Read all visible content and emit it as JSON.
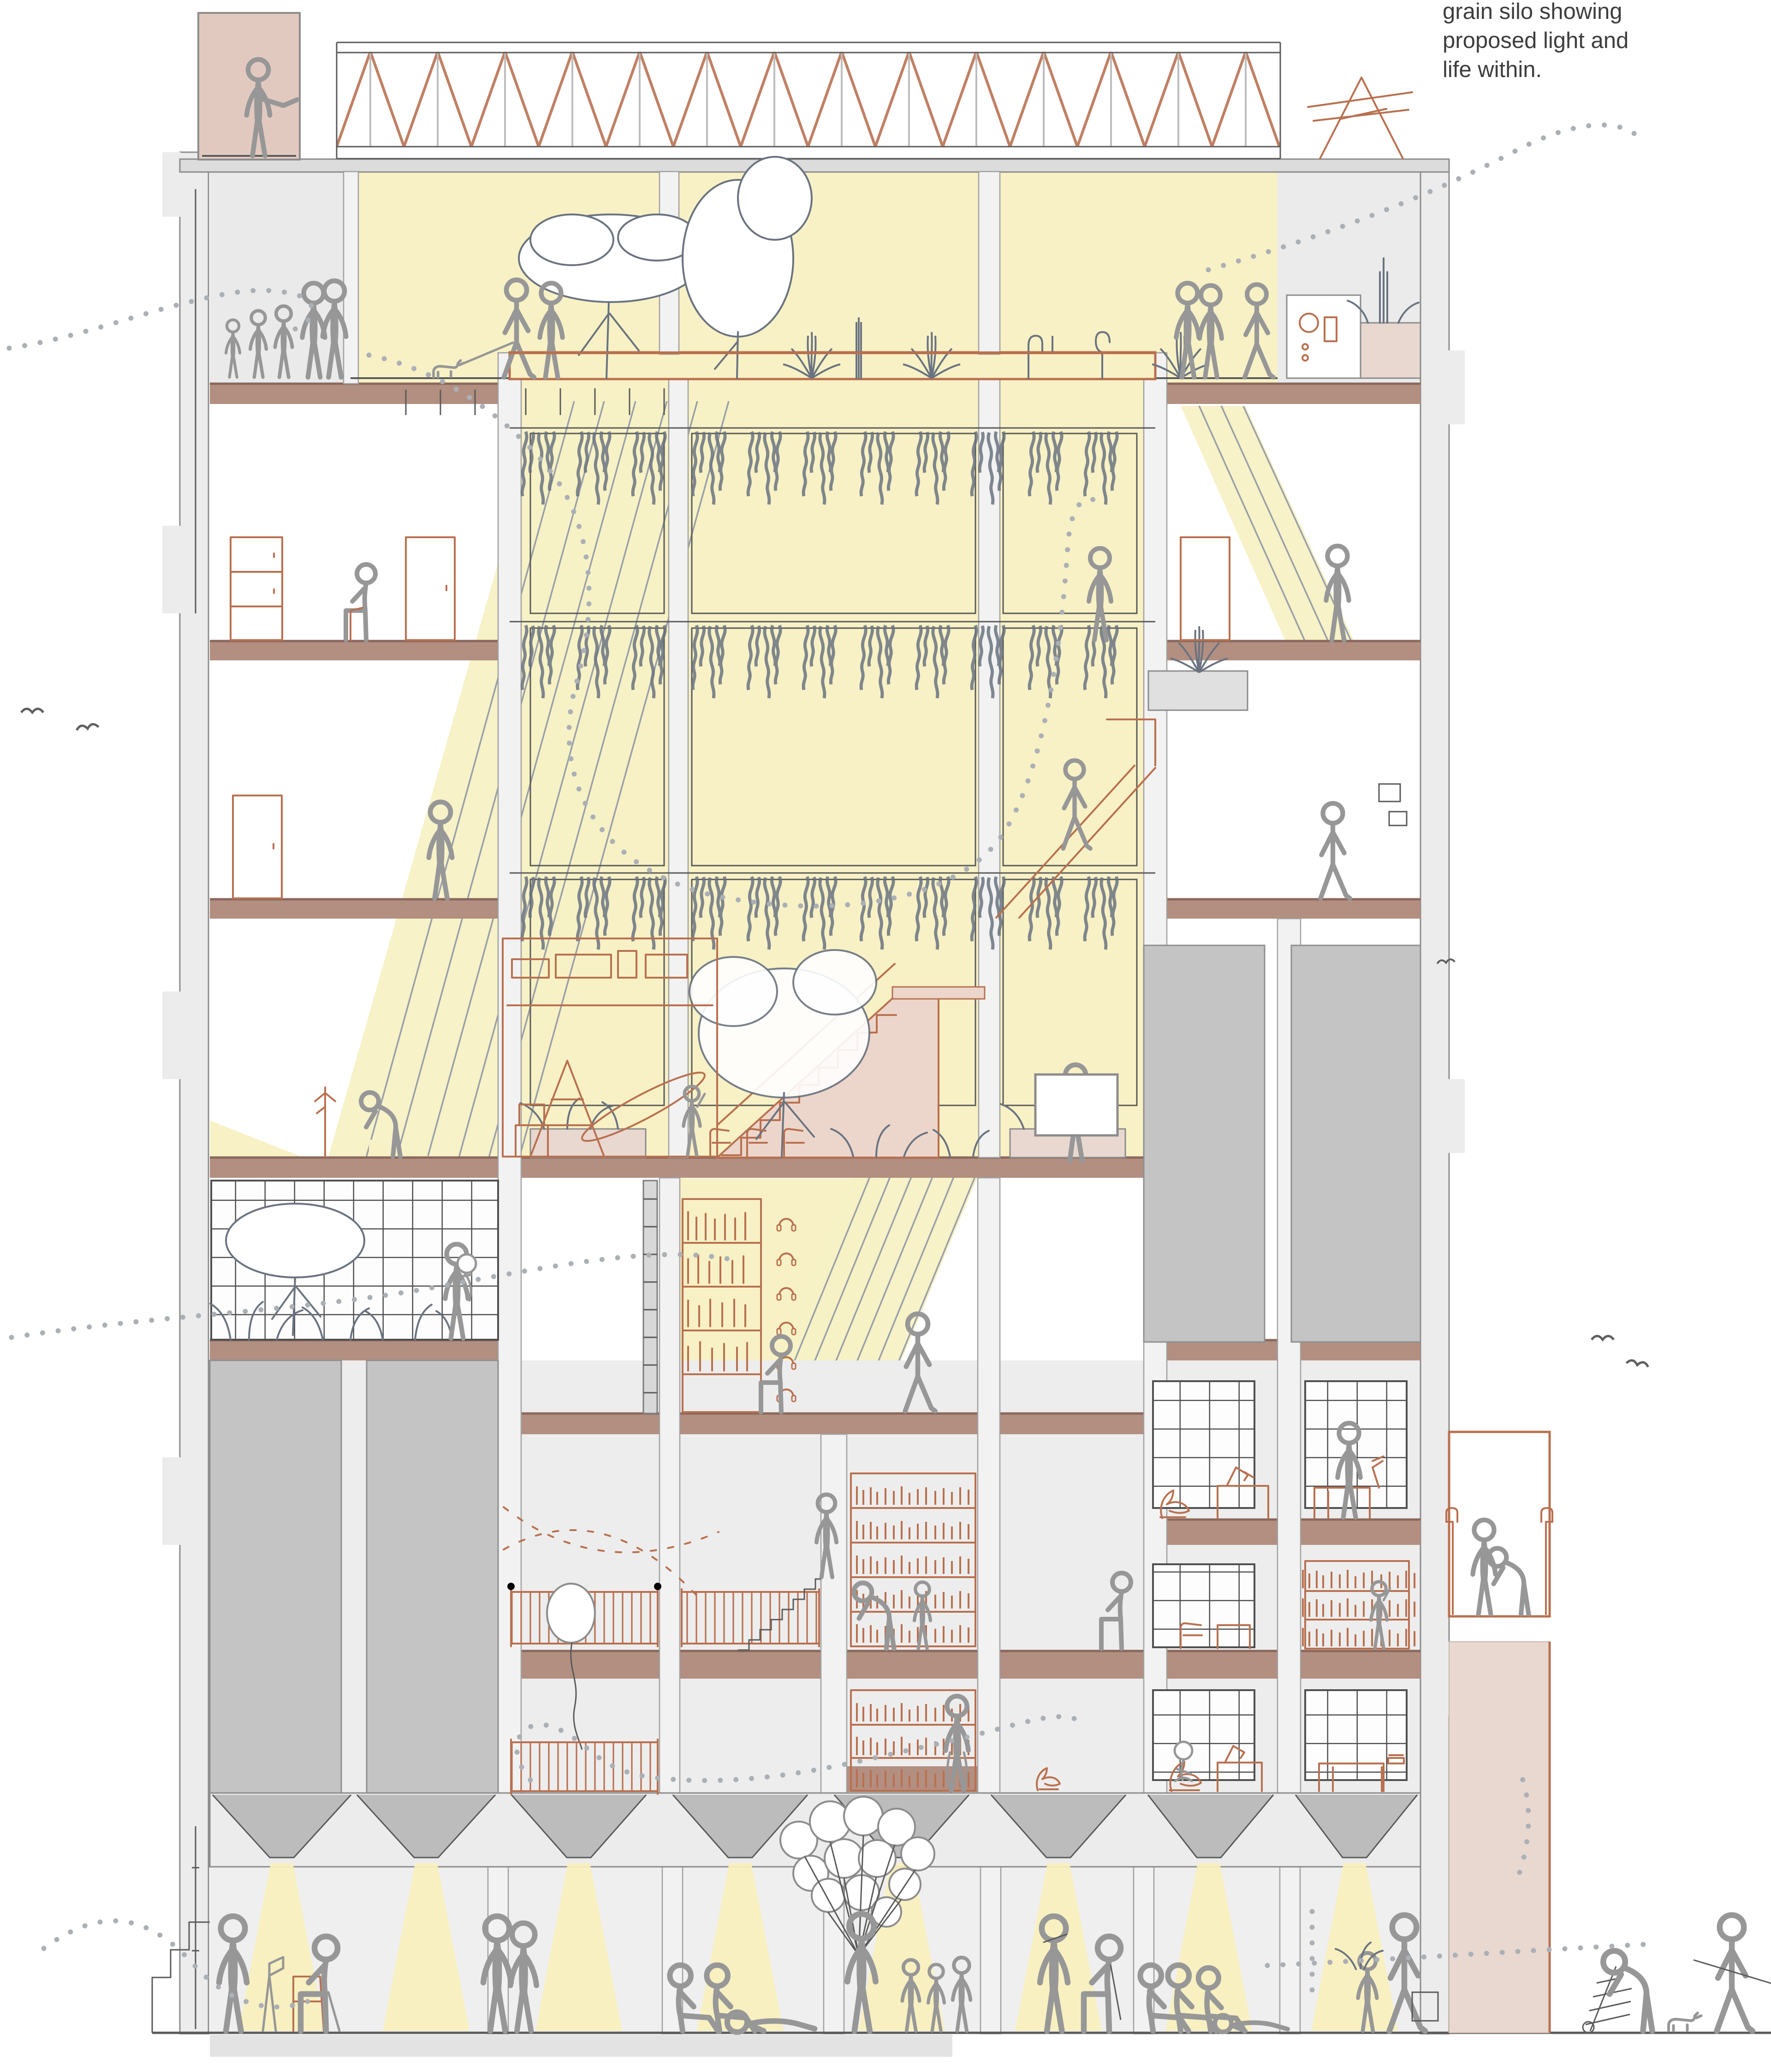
{
  "caption": {
    "line1": "grain silo showing",
    "line2": "proposed light and",
    "line3": "life within."
  },
  "colors": {
    "bg": "#ffffff",
    "ink": "#5a5a5a",
    "wallFill": "#ececec",
    "wallLine": "#8c8c8c",
    "columnFill": "#f2f2f2",
    "columnLine": "#a0a0a0",
    "slab": "#b28f81",
    "slabEdge": "#8a675c",
    "pinkWall": "#e9d8d0",
    "pinkTower": "#e2c9c0",
    "stairFill": "#ecd6cb",
    "accent": "#b9704f",
    "lightYellow": "#f7f1c5",
    "lightBeam": "#f8f0bd",
    "binGray": "#c4c4c4",
    "hopperGray": "#bcbcbc",
    "gridLine": "#4f4f4f",
    "plantInk": "#6a7380",
    "figureInk": "#979797",
    "airflowDot": "#abb0b6",
    "stripe": "#9aa0a8",
    "caption": "#3d3d3d"
  }
}
